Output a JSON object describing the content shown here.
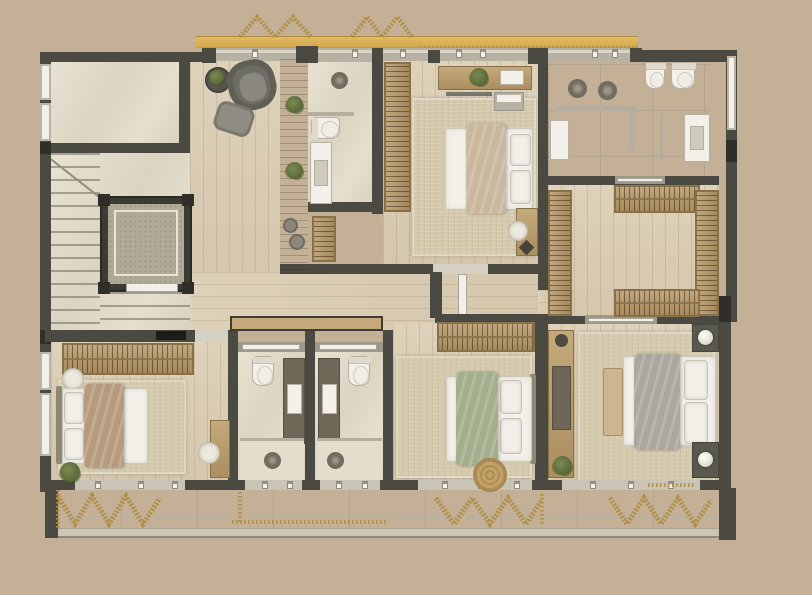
{
  "scene": {
    "label": "Top-down rendered architectural floor plan of an upper residential storey with four bedrooms, four bathrooms, walk-in closet, lounge, staircase with elevator, gold awning and a full-width balcony",
    "type": "floor-plan"
  },
  "colors": {
    "background": "#c3b096",
    "wall": "#4b4a42",
    "wall_dark": "#2f2e28",
    "wood": "#dccfb6",
    "marble": "#e4decd",
    "rug": "#d4caae",
    "wardrobe": "#b89b6c",
    "wardrobe_dark": "#8a7048",
    "wood_furniture": "#c4a97b",
    "feature_wall": "#554839",
    "awning": "#ddb45a",
    "rope": "#b28f49",
    "white": "#f2f0e9",
    "fixture_border": "#b5b0a2",
    "glass": "#b3aea0",
    "railing": "#ccc6b5",
    "duvet_beige": "#c9b79e",
    "duvet_brown": "#b59b7e",
    "duvet_green": "#a3ae8d",
    "duvet_gray": "#aba69e",
    "plant": "#5d6d3c",
    "plant_dark": "#41511f"
  },
  "rooms": [
    {
      "id": "terrace-room",
      "name": "Terrace room"
    },
    {
      "id": "stair-hall",
      "name": "Staircase hall"
    },
    {
      "id": "elevator",
      "name": "Elevator"
    },
    {
      "id": "lounge",
      "name": "Lounge"
    },
    {
      "id": "hallway",
      "name": "Hallway"
    },
    {
      "id": "bedroom-top",
      "name": "Bedroom (top)"
    },
    {
      "id": "ensuite-bathroom",
      "name": "En-suite bathroom"
    },
    {
      "id": "master-bathroom",
      "name": "Master bathroom with double shower"
    },
    {
      "id": "walk-in-closet",
      "name": "Walk-in closet"
    },
    {
      "id": "bedroom-left",
      "name": "Bedroom (bottom left)"
    },
    {
      "id": "bathroom-a",
      "name": "Bathroom A"
    },
    {
      "id": "bathroom-b",
      "name": "Bathroom B"
    },
    {
      "id": "bedroom-middle",
      "name": "Bedroom (bottom middle)"
    },
    {
      "id": "master-bedroom",
      "name": "Master bedroom"
    },
    {
      "id": "balcony",
      "name": "Balcony"
    },
    {
      "id": "awning",
      "name": "Gold awning"
    }
  ]
}
